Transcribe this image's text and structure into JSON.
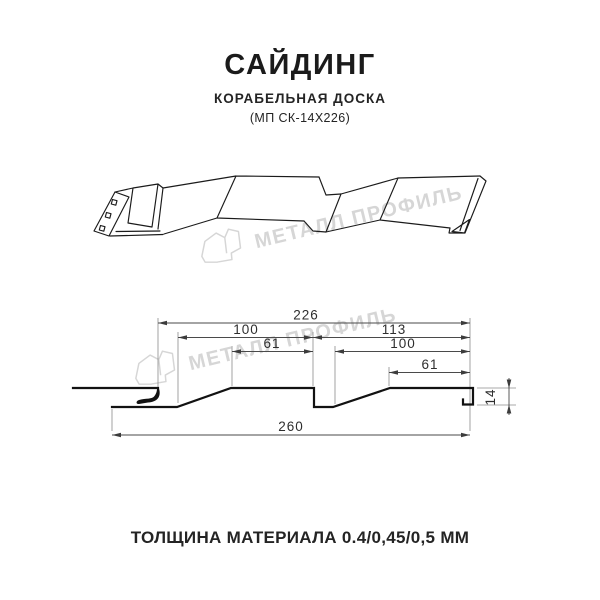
{
  "header": {
    "title": "САЙДИНГ",
    "subtitle": "КОРАБЕЛЬНАЯ ДОСКА",
    "model": "(МП СК-14Х226)"
  },
  "watermark": {
    "brand": "МЕТАЛЛ ПРОФИЛЬ",
    "color": "#d6d6d6"
  },
  "drawing": {
    "dimensions_mm": {
      "overall_width": 260,
      "cover_width": 226,
      "left_board_width": 100,
      "right_board_width": 113,
      "left_flat_width": 61,
      "right_board_top": 100,
      "right_flat_width": 61,
      "profile_depth": 14
    },
    "labels": {
      "d226": "226",
      "d100l": "100",
      "d113": "113",
      "d61l": "61",
      "d100r": "100",
      "d61r": "61",
      "d260": "260",
      "d14": "14"
    }
  },
  "footer": {
    "thickness_note": "ТОЛЩИНА МАТЕРИАЛА 0.4/0,45/0,5 ММ"
  }
}
